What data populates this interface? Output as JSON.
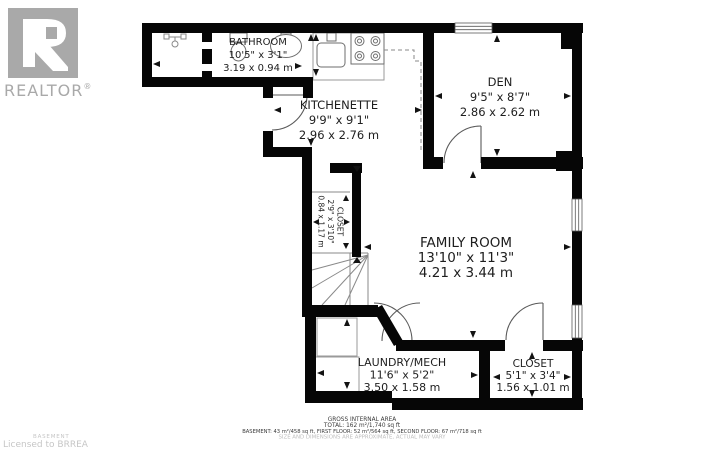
{
  "branding": {
    "logo_text": "REALTOR",
    "registered_mark": "®"
  },
  "watermark": {
    "floor_label": "BASEMENT",
    "license_text": "Licensed to BRREA"
  },
  "rooms": {
    "bathroom": {
      "name": "BATHROOM",
      "imperial": "10'5\" x 3'1\"",
      "metric": "3.19 x 0.94 m"
    },
    "kitchenette": {
      "name": "KITCHENETTE",
      "imperial": "9'9\" x 9'1\"",
      "metric": "2.96 x 2.76 m"
    },
    "den": {
      "name": "DEN",
      "imperial": "9'5\" x 8'7\"",
      "metric": "2.86 x 2.62 m"
    },
    "family_room": {
      "name": "FAMILY ROOM",
      "imperial": "13'10\" x 11'3\"",
      "metric": "4.21 x 3.44 m"
    },
    "hall_closet": {
      "name": "CLOSET",
      "imperial": "2'9\" x 3'10\"",
      "metric": "0.84 x 1.17 m"
    },
    "laundry": {
      "name": "LAUNDRY/MECH",
      "imperial": "11'6\" x 5'2\"",
      "metric": "3.50 x 1.58 m"
    },
    "bedroom_closet": {
      "name": "CLOSET",
      "imperial": "5'1\" x 3'4\"",
      "metric": "1.56 x 1.01 m"
    }
  },
  "area_summary": {
    "title": "GROSS INTERNAL AREA",
    "total": "TOTAL: 162 m²/1,740 sq ft",
    "breakdown": "BASEMENT: 43 m²/458 sq ft, FIRST FLOOR: 52 m²/564 sq ft, SECOND FLOOR: 67 m²/718 sq ft",
    "disclaimer": "SIZE AND DIMENSIONS ARE APPROXIMATE, ACTUAL MAY VARY"
  },
  "colors": {
    "wall": "#060606",
    "label_text": "#1e1e1e",
    "logo_gray": "#a9a9a9",
    "watermark_gray": "#c6c6c6",
    "summary_text": "#3a3a3a",
    "disclaimer_gray": "#bdbdbd",
    "arrow": "#121212"
  }
}
